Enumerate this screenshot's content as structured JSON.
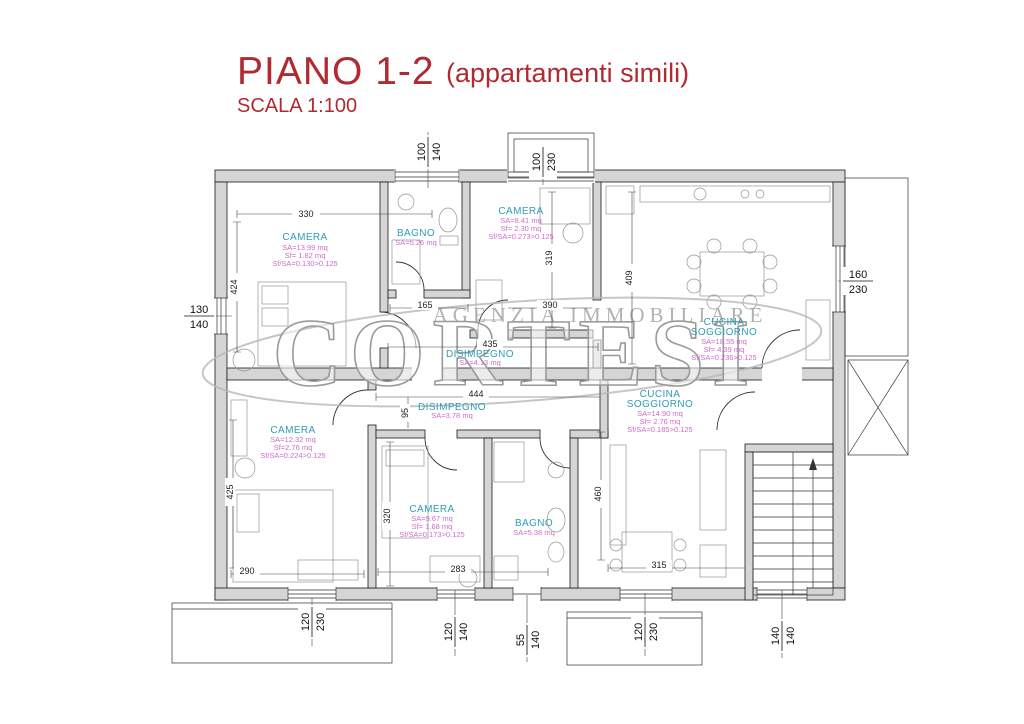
{
  "title": {
    "main": "PIANO 1-2",
    "suffix": "(appartamenti simili)",
    "scale": "SCALA 1:100"
  },
  "watermark": {
    "agency": "AGENZIA IMMOBILIARE",
    "name": "CORTESI"
  },
  "colors": {
    "title_red": "#b12a31",
    "room_label_teal": "#2f9db4",
    "area_magenta": "#cf6cc8",
    "wall_gray": "#d5d5d5",
    "watermark_gray": "#9a9a9a"
  },
  "rooms": {
    "camera_tl": {
      "name": "CAMERA",
      "sa": "SA=13.99 mq",
      "sf": "Sf= 1.82 mq",
      "ratio": "Sf/SA=0.130>0.125"
    },
    "bagno_top": {
      "name": "BAGNO",
      "sa": "SA=5.26 mq"
    },
    "camera_tc": {
      "name": "CAMERA",
      "sa": "SA=8.41 mq",
      "sf": "Sf= 2.30 mq",
      "ratio": "Sf/SA=0.273>0.125"
    },
    "cucina_top": {
      "name1": "CUCINA",
      "name2": "SOGGIORNO",
      "sa": "SA=18.55 mq",
      "sf": "Sf= 4.39 mq",
      "ratio": "Sf/SA=0.236>0.125"
    },
    "disimpegno_top": {
      "name": "DISIMPEGNO",
      "sa": "SA=4.13 mq"
    },
    "disimpegno_bottom": {
      "name": "DISIMPEGNO",
      "sa": "SA=3.78 mq"
    },
    "camera_bl": {
      "name": "CAMERA",
      "sa": "SA=12.32 mq",
      "sf": "Sf=2.76 mq",
      "ratio": "Sf/SA=0.224>0.125"
    },
    "camera_bc": {
      "name": "CAMERA",
      "sa": "SA=9.67 mq",
      "sf": "Sf= 1.68 mq",
      "ratio": "Sf/SA=0.173>0.125"
    },
    "bagno_bottom": {
      "name": "BAGNO",
      "sa": "SA=5.38 mq"
    },
    "cucina_bottom": {
      "name1": "CUCINA",
      "name2": "SOGGIORNO",
      "sa": "SA=14.90 mq",
      "sf": "Sf= 2.76 mq",
      "ratio": "Sf/SA=0.185>0.125"
    }
  },
  "dimensions": {
    "d330": "330",
    "d424": "424",
    "d319": "319",
    "d409": "409",
    "d165": "165",
    "d390": "390",
    "d435": "435",
    "d444": "444",
    "d95": "95",
    "d425": "425",
    "d320": "320",
    "d460": "460",
    "d290": "290",
    "d283": "283",
    "d315": "315"
  },
  "openings": {
    "top_window": {
      "w": "100",
      "h": "140"
    },
    "top_box": {
      "w": "100",
      "h": "230"
    },
    "left_window": {
      "w": "130",
      "h": "140"
    },
    "right_window": {
      "w": "160",
      "h": "230"
    },
    "bottom_w1": {
      "w": "120",
      "h": "230"
    },
    "bottom_w2": {
      "w": "120",
      "h": "140"
    },
    "bottom_w3": {
      "w": "55",
      "h": "140"
    },
    "bottom_w4": {
      "w": "120",
      "h": "230"
    },
    "bottom_w5": {
      "w": "140",
      "h": "140"
    }
  }
}
